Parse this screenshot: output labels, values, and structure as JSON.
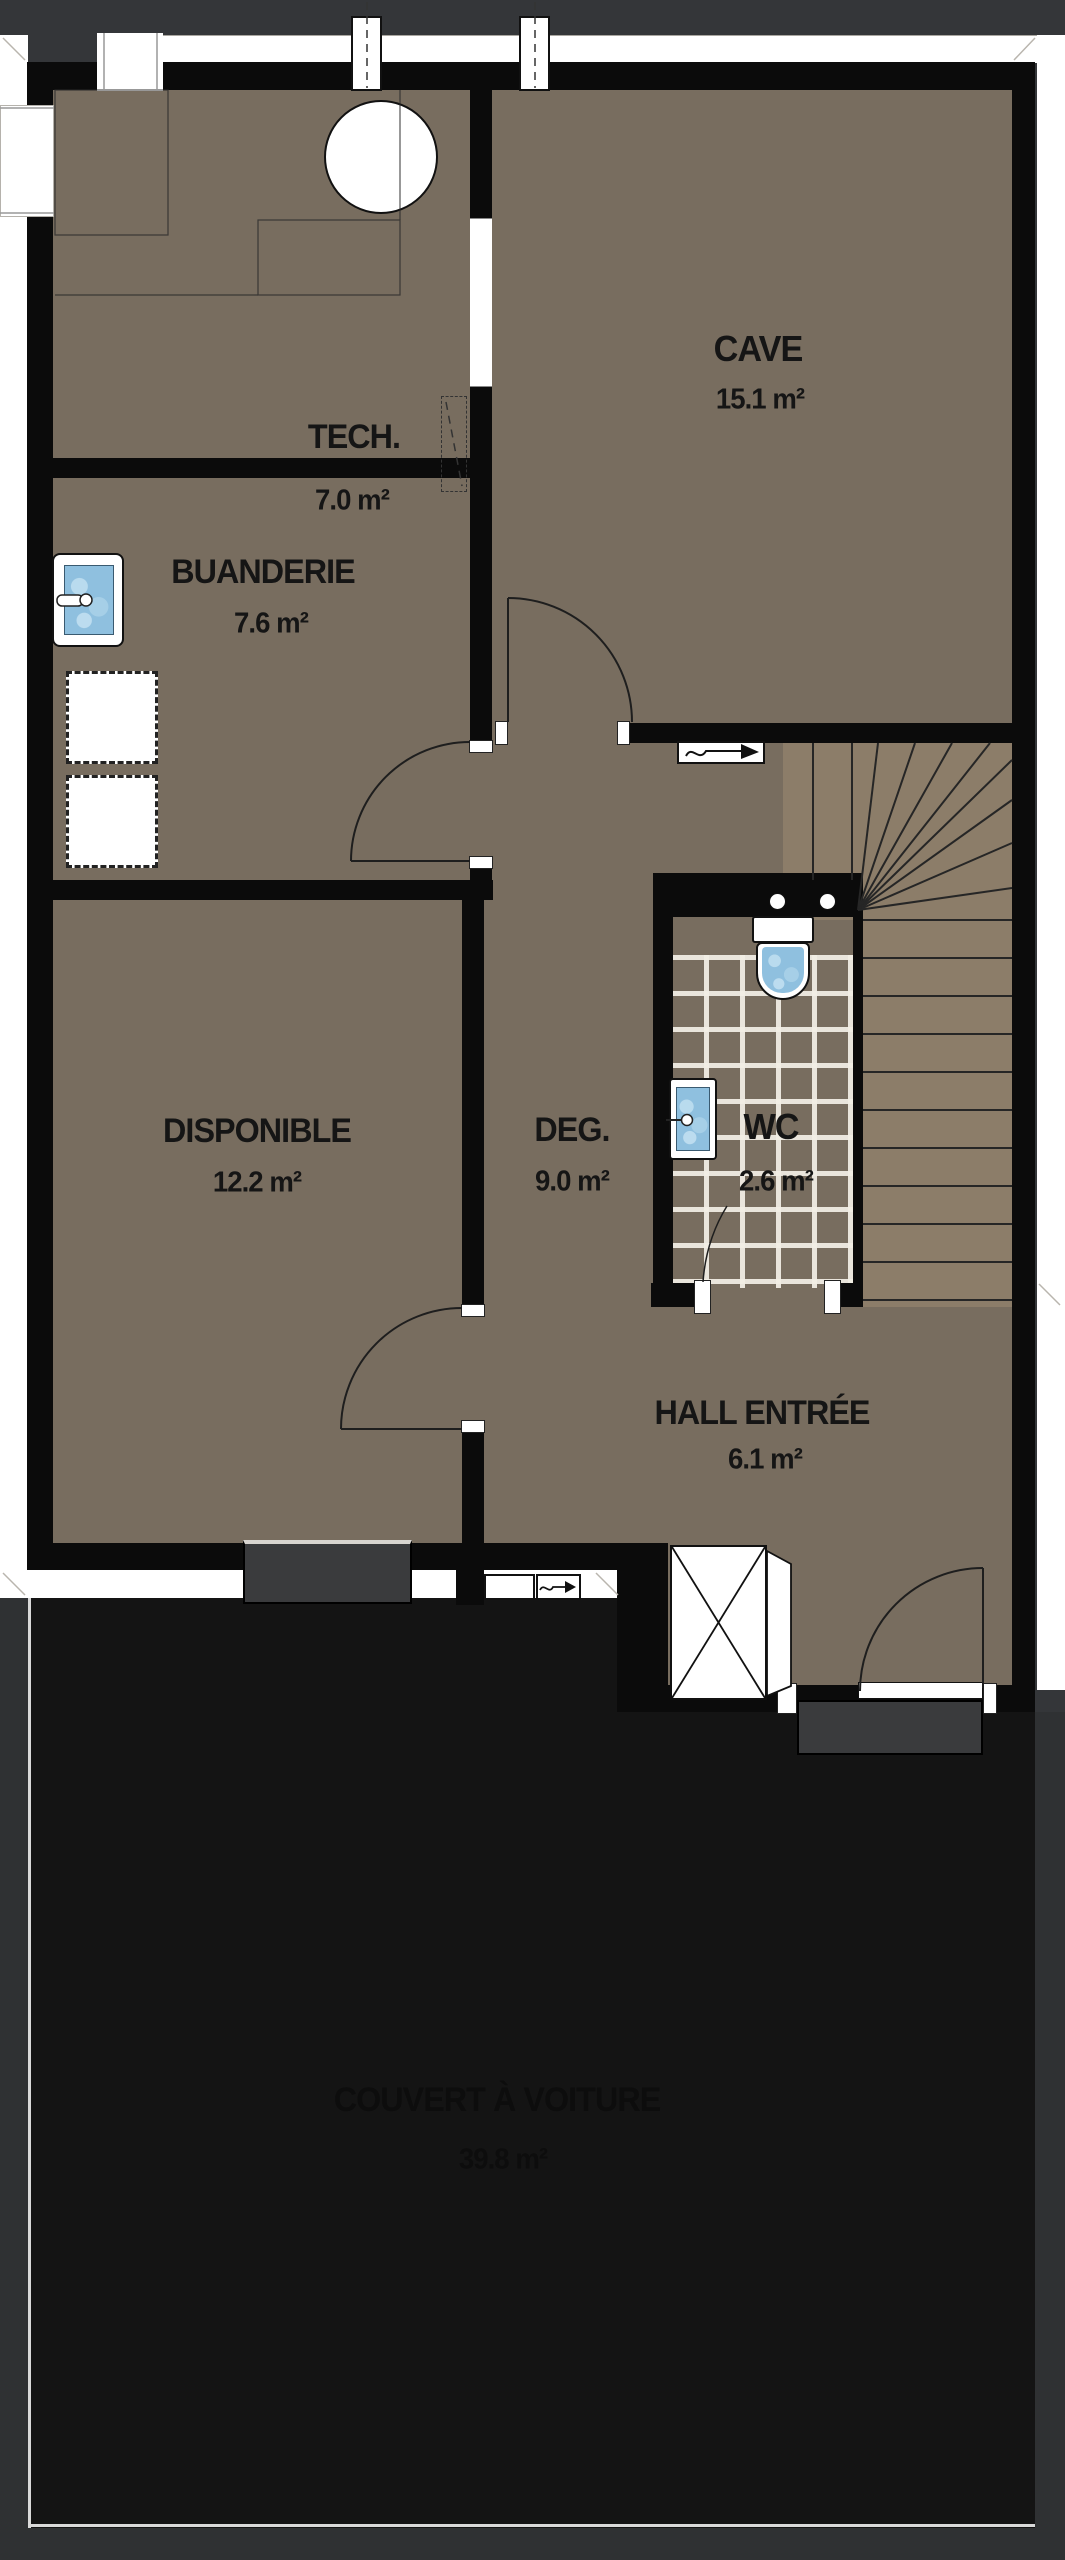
{
  "plan": {
    "type": "architectural-floor-plan",
    "level": "basement / ground entry",
    "rooms": [
      {
        "id": "tech",
        "name": "TECH.",
        "area": "7.0 m²"
      },
      {
        "id": "cave",
        "name": "CAVE",
        "area": "15.1 m²"
      },
      {
        "id": "buanderie",
        "name": "BUANDERIE",
        "area": "7.6 m²"
      },
      {
        "id": "disponible",
        "name": "DISPONIBLE",
        "area": "12.2 m²"
      },
      {
        "id": "deg",
        "name": "DEG.",
        "area": "9.0 m²"
      },
      {
        "id": "wc",
        "name": "WC",
        "area": "2.6 m²"
      },
      {
        "id": "hall",
        "name": "HALL ENTRÉE",
        "area": "6.1 m²"
      },
      {
        "id": "couvert",
        "name": "COUVERT À VOITURE",
        "area": "39.8 m²"
      }
    ],
    "fixtures": [
      "boiler",
      "laundry-sink",
      "washer-dryer-slots",
      "wc-toilet",
      "wc-sink",
      "winder-staircase",
      "light-shaft",
      "entry-porch-steps"
    ],
    "colors": {
      "floor": "#786d5f",
      "stairFloor": "#8c7d69",
      "wall": "#0b0b0b",
      "outside": "#343639",
      "carport": "#141414",
      "carportFrame": "#2f3133",
      "water": "#8fc0df",
      "porch": "#3a3b3d"
    }
  }
}
